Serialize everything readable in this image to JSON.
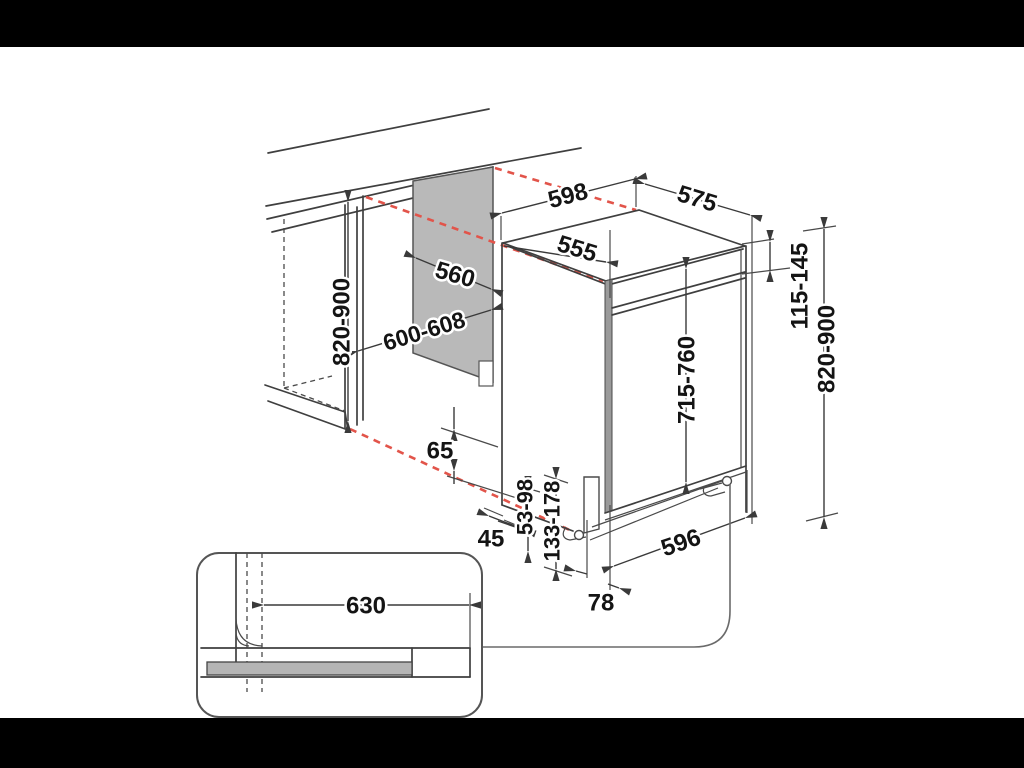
{
  "colors": {
    "background": "#ffffff",
    "letterbox": "#000000",
    "line": "#3f3f3f",
    "red_dashed": "#e2544a",
    "panel_gray": "#b9b9b9",
    "bar_gray": "#b5b5b5",
    "text": "#141414"
  },
  "diagram": {
    "labels": {
      "top_width": "598",
      "depth": "575",
      "top_inset_depth": "555",
      "panel_depth": "560",
      "niche_width": "600-608",
      "niche_height": "820-900",
      "top_gap": "115-145",
      "overall_height": "820-900",
      "door_height": "715-760",
      "plinth_clearance": "65",
      "front_offset": "45",
      "foot_height_front": "53-98",
      "foot_height_rear": "133-178",
      "base_width": "596",
      "rear_foot_offset": "78",
      "hose_reach": "630"
    }
  }
}
